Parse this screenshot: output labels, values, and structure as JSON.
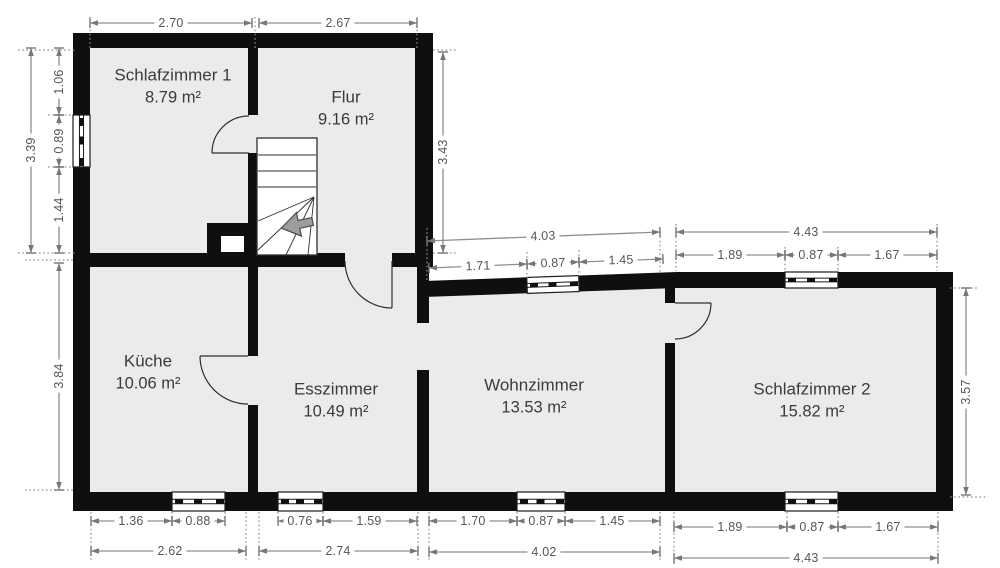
{
  "plan": {
    "title": "Grundriss Wohnung",
    "unit": "m",
    "rooms": [
      {
        "id": "schlafzimmer1",
        "name": "Schlafzimmer 1",
        "area": "8.79 m²"
      },
      {
        "id": "flur",
        "name": "Flur",
        "area": "9.16 m²"
      },
      {
        "id": "kueche",
        "name": "Küche",
        "area": "10.06 m²"
      },
      {
        "id": "esszimmer",
        "name": "Esszimmer",
        "area": "10.49 m²"
      },
      {
        "id": "wohnzimmer",
        "name": "Wohnzimmer",
        "area": "13.53 m²"
      },
      {
        "id": "schlafzimmer2",
        "name": "Schlafzimmer 2",
        "area": "15.82 m²"
      }
    ],
    "dimensions": {
      "top": [
        "2.70",
        "2.67"
      ],
      "left": {
        "total": "3.39",
        "segments": [
          "1.06",
          "0.89",
          "1.44"
        ],
        "lower": "3.84"
      },
      "flur_right": "3.43",
      "wohnzimmer_top": {
        "total": "4.03",
        "segments": [
          "1.71",
          "0.87",
          "1.45"
        ]
      },
      "schlafzimmer2_top": {
        "total": "4.43",
        "segments": [
          "1.89",
          "0.87",
          "1.67"
        ]
      },
      "schlafzimmer2_right": "3.57",
      "kueche_bottom": {
        "segments": [
          "1.36",
          "0.88"
        ],
        "total": "2.62"
      },
      "esszimmer_bottom": {
        "segments": [
          "0.76",
          "1.59"
        ],
        "total": "2.74"
      },
      "wohnzimmer_bottom": {
        "segments": [
          "1.70",
          "0.87",
          "1.45"
        ],
        "total": "4.02"
      },
      "schlafzimmer2_bottom": {
        "segments": [
          "1.89",
          "0.87",
          "1.67"
        ],
        "total": "4.43"
      }
    },
    "features": {
      "stairs_arrow_direction": "left",
      "doors": 4,
      "windows": 7
    },
    "colors": {
      "wall": "#0f0f0f",
      "floor": "#ebebec",
      "dimension_line": "#8f8f8f",
      "dimension_text": "#565656",
      "room_text": "#3b3b3b",
      "stairs_arrow": "#9c9c9c",
      "background": "#ffffff"
    }
  }
}
